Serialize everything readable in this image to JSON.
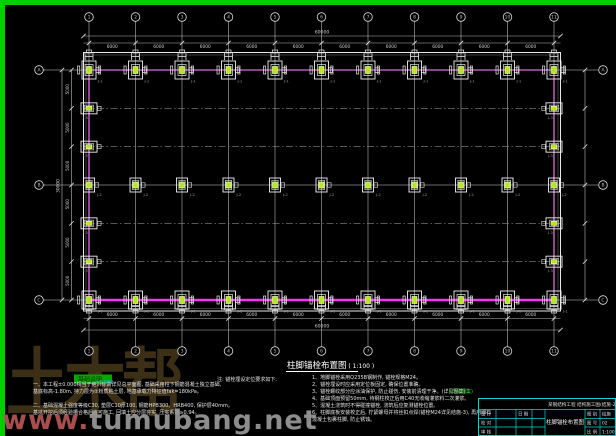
{
  "drawing": {
    "caption": {
      "title": "柱脚锚栓布置图",
      "scale": "1:100"
    },
    "axes": {
      "cols": {
        "labels": [
          "1",
          "2",
          "3",
          "4",
          "5",
          "6",
          "7",
          "8",
          "9",
          "10",
          "11"
        ]
      },
      "rows": {
        "labels": [
          "A",
          "B",
          "C"
        ]
      }
    },
    "dimensions": {
      "bay": "6000",
      "total_width": "60000",
      "edge_segment": "5000",
      "total_depth": "30000"
    },
    "footings": {
      "frame_label": "J-1",
      "middle_label": "J-2",
      "edge_label": "J-3"
    },
    "colors": {
      "border_green": "#00cf00",
      "grid": "#8a8a8a",
      "outline": "#e8e8e8",
      "axis_magenta": "#b55ab5",
      "beam_magenta": "#f832f8",
      "anchor_green_fill": "#b4e622",
      "anchor_green_edge": "#eaffa0",
      "dim_text": "#cfcfcf",
      "titleblock_cyan": "#00d9d9",
      "note_text": "#e4e4e4",
      "label_gray": "#9a9a9a"
    }
  },
  "notes": {
    "header": "基础说明",
    "left": [
      "一、本工程±0.000相当于绝对标高详见总平面图, 基础采用柱下钢筋混凝土独立基础,",
      "      基底标高-1.80m, 持力层为②粉质粘土层, 地基承载力特征值fak=180kPa。",
      "二、基础混凝土强度等级C30, 垫层C10厚100, 钢筋HPB300、HRB400, 保护层40mm。",
      "      基坑开挖后须经验槽合格后方可施工, 回填土应分层夯实, 压实系数≥0.94。"
    ],
    "mid": "注: 锚栓埋设定位要求如下:",
    "right": [
      "1、地脚锚栓采用Q235B钢制作, 锚栓规格M24。",
      "2、锚栓埋设时应采用定位板固定, 确保位置准确。",
      "3、锚栓螺纹部分应涂油保护, 防止碰伤, 安装前清理干净。(详见图集)",
      "4、基础顶面预留50mm, 待钢柱校正后用C40无收缩灌浆料二次灌浆。",
      "5、混凝土浇筑时不得碰撞锚栓, 浇筑后应复测锚栓位置。",
      "6、柱脚底板安装校正后, 拧紧螺母并将丝扣点焊(锚栓M24详见结施-3), 再用细石",
      "      混凝土包裹柱脚, 防止锈蚀。"
    ],
    "highlights": [
      {
        "text": "(详见图集)",
        "x": 449,
        "y": 393,
        "color": "#35d435"
      },
      {
        "text": "±0.000",
        "x": 95,
        "y": 384,
        "color": "#3fa9ff"
      }
    ]
  },
  "title_block": {
    "project": "某钢结构工程 结构施工图(结施-2)",
    "drawing_name": "柱脚锚栓布置图",
    "cells": {
      "design": "设 计",
      "check": "校 对",
      "review": "审 核",
      "date": "日 期",
      "sheet_type_label": "图 别",
      "sheet_type": "结施",
      "sheet_no_label": "图 号",
      "sheet_no": "02",
      "scale_label": "比 例",
      "scale": "1:100"
    }
  },
  "watermark": {
    "brand": "土木帮",
    "url_prefix": "www.",
    "url_rest": "tumubang.net"
  }
}
